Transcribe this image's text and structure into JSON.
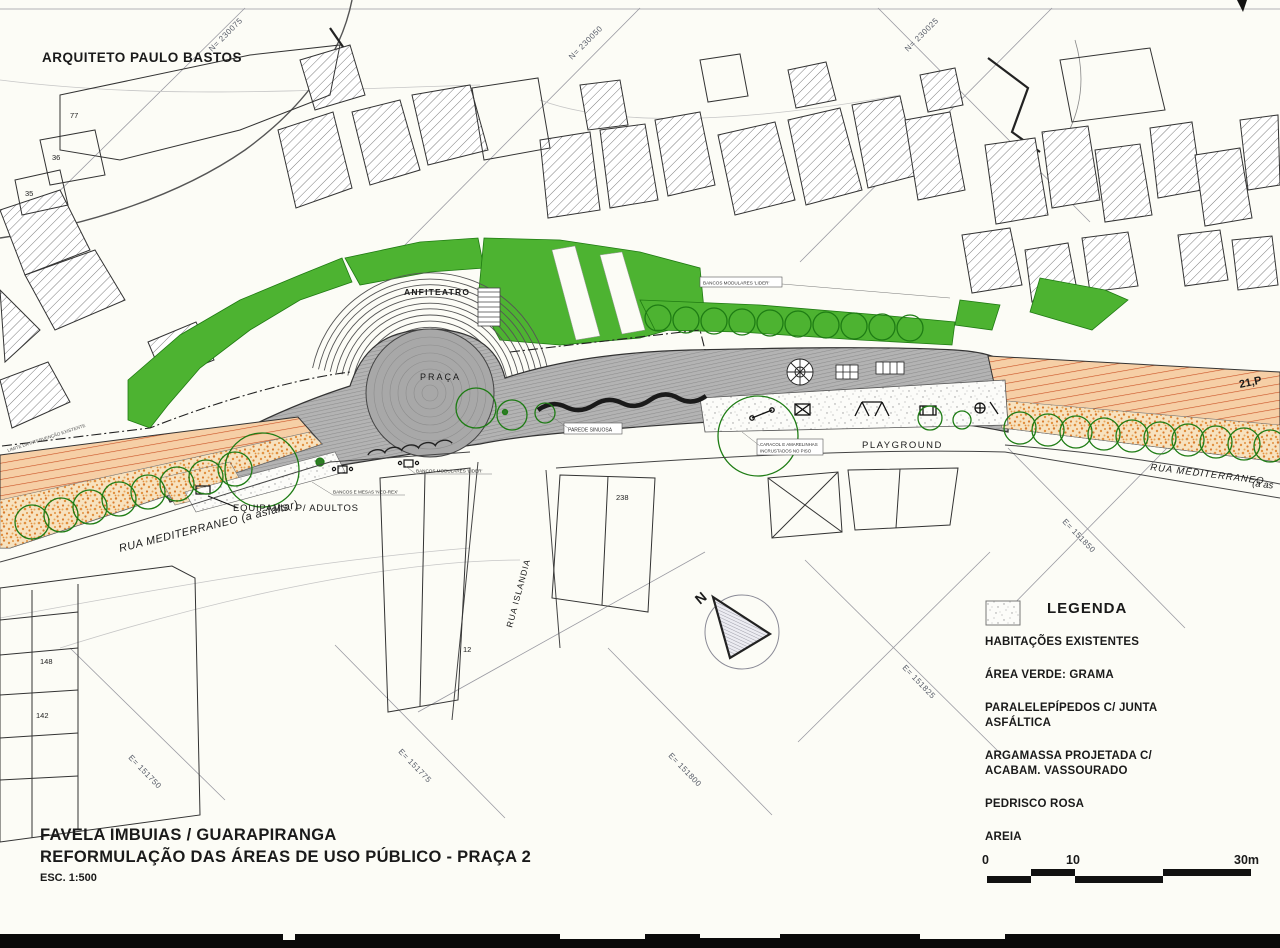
{
  "map": {
    "architect": "ARQUITETO PAULO BASTOS",
    "labels": {
      "anfiteatro": "ANFITEATRO",
      "praca": "PRAÇA",
      "playground": "PLAYGROUND",
      "parede_sinuosa": "PAREDE SINUOSA",
      "caracol_1": "CARACOL E AMARELINHAS",
      "caracol_2": "INCRUSTADOS NO PISO",
      "bancos_modulares_top": "BANCOS MODULARES 'LIDER'",
      "bancos_modulares_mid": "BANCOS MODULARES 'LIDER'",
      "bancos_mesas": "BANCOS E MESAS 'NEO-REX'",
      "equipams": "EQUIPAMS. P/ ADULTOS",
      "rua_mediterraneo_left": "RUA MEDITERRANEO  (a asfaltar)",
      "rua_mediterraneo_right": "RUA MEDITERRANEO",
      "rua_mediterraneo_right_suffix": "(a as",
      "rua_islandia": "RUA ISLANDIA",
      "north": "N",
      "edge_note": "21,P",
      "limite": "LIMITE DA INTERVENÇÃO EXISTENTE"
    },
    "coordinates": [
      "N= 230075",
      "N= 230050",
      "N= 230025",
      "E= 151750",
      "E= 151775",
      "E= 151800",
      "E= 151825",
      "E= 151850"
    ],
    "house_numbers": [
      "77",
      "36",
      "35",
      "148",
      "142",
      "238",
      "12"
    ]
  },
  "legend": {
    "title": "LEGENDA",
    "items": [
      {
        "label": "HABITAÇÕES EXISTENTES",
        "swatch": "hatch"
      },
      {
        "label": "ÁREA VERDE: GRAMA",
        "swatch": "green"
      },
      {
        "label": "PARALELEPÍPEDOS C/ JUNTA ASFÁLTICA",
        "swatch": "paving"
      },
      {
        "label": "ARGAMASSA PROJETADA C/ ACABAM. VASSOURADO",
        "swatch": "argamassa"
      },
      {
        "label": "PEDRISCO ROSA",
        "swatch": "pedrisco"
      },
      {
        "label": "AREIA",
        "swatch": "areia"
      }
    ]
  },
  "title_block": {
    "line1": "FAVELA IMBUIAS / GUARAPIRANGA",
    "line2": "REFORMULAÇÃO DAS ÁREAS DE USO PÚBLICO  -  PRAÇA 2",
    "line3": "ESC. 1:500"
  },
  "scale_bar": {
    "ticks": [
      "0",
      "10",
      "30m"
    ]
  },
  "colors": {
    "grass_green": "#4db331",
    "paving_gray": "#b3b3b3",
    "argamassa_orange": "#f6cfa6",
    "argamassa_line_red": "#c94f22",
    "pedrisco_dot": "#e2913f",
    "ink": "#1a1a1a"
  }
}
